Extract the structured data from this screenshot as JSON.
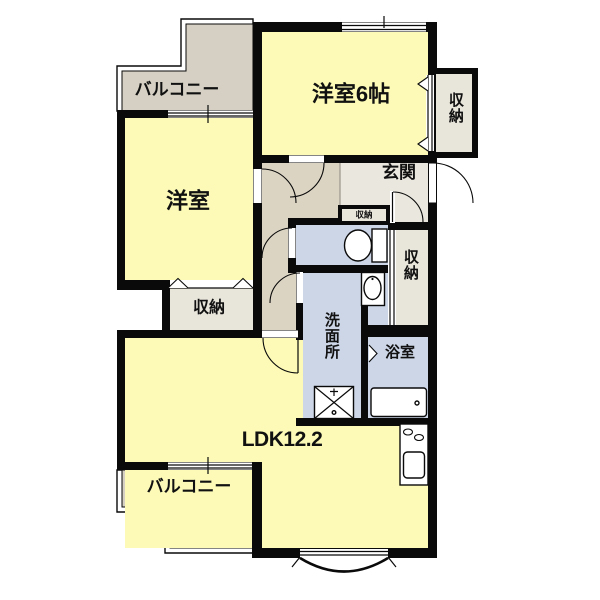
{
  "rooms": {
    "balcony_top": {
      "label": "バルコニー"
    },
    "bedroom_top": {
      "label": "洋室6帖"
    },
    "closet_top_right": {
      "label": "収納"
    },
    "bedroom_left": {
      "label": "洋室"
    },
    "entrance": {
      "label": "玄関"
    },
    "closet_small": {
      "label": "収納"
    },
    "closet_right": {
      "label": "収納"
    },
    "closet_left": {
      "label": "収納"
    },
    "washroom": {
      "label": "洗面所"
    },
    "bathroom": {
      "label": "浴室"
    },
    "ldk": {
      "label": "LDK12.2"
    },
    "balcony_bottom": {
      "label": "バルコニー"
    }
  },
  "colors": {
    "room_yellow": "#FCFAB6",
    "balcony_gray": "#D5D0C3",
    "hall_tan": "#DCD4C3",
    "entry_gray": "#EAE7DE",
    "closet_gray": "#E8E5DB",
    "wet_blue": "#CCD6E7",
    "wall_black": "#0A0A0A"
  }
}
